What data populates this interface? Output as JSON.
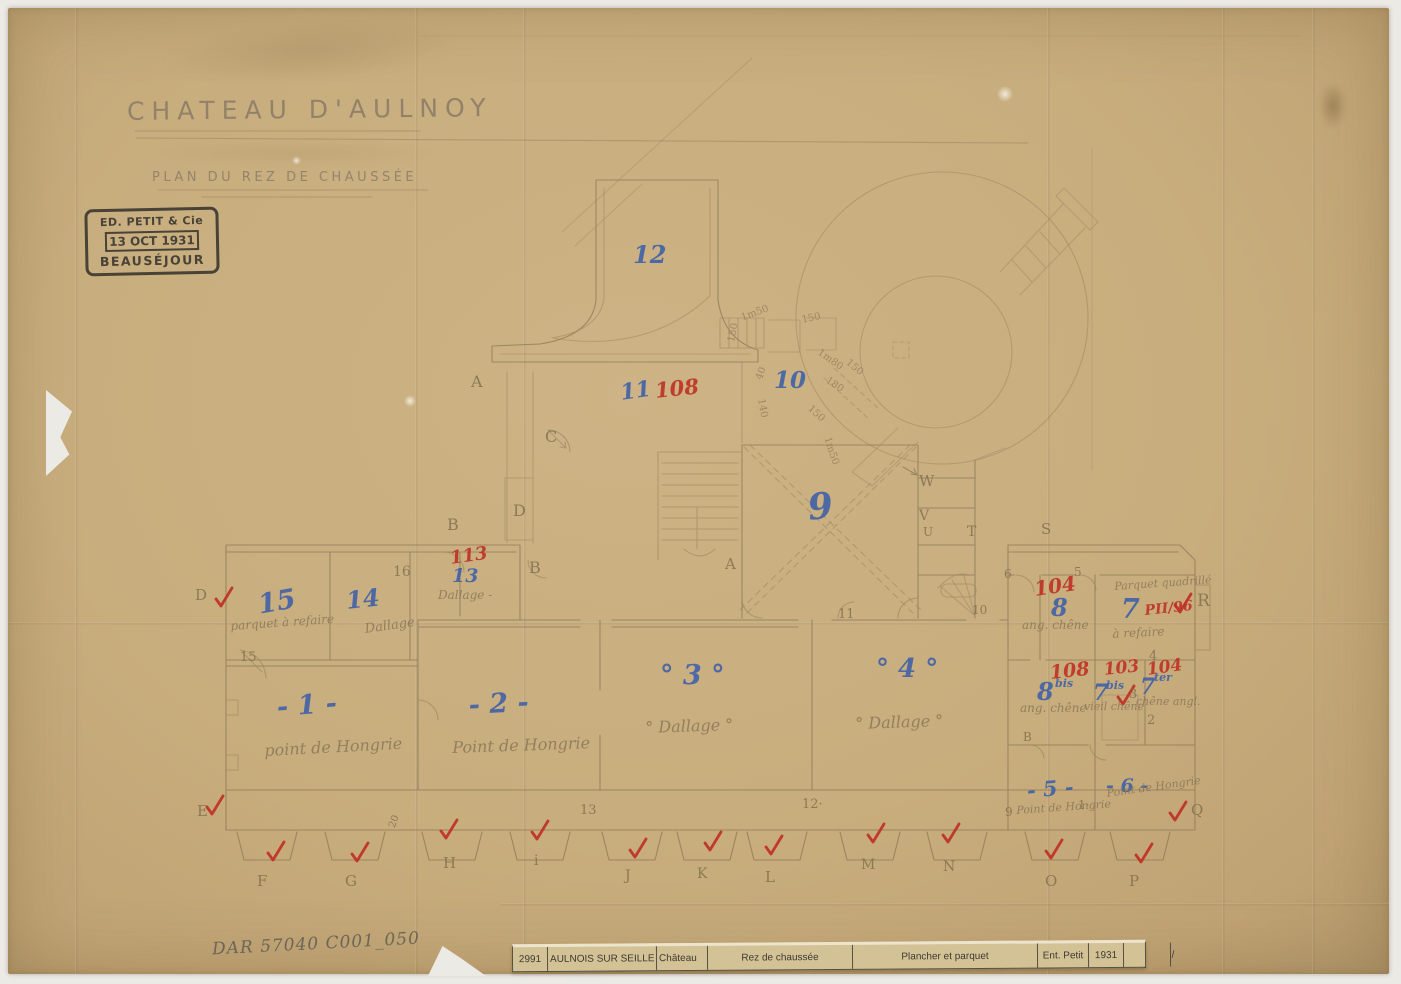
{
  "header": {
    "title": "CHATEAU D'AULNOY",
    "subtitle": "PLAN DU REZ DE CHAUSSÉE"
  },
  "stamp": {
    "line1": "ED. PETIT & Cie",
    "line2": "13 OCT 1931",
    "line3": "BEAUSÉJOUR"
  },
  "archive_ref": "DAR 57040 C001_050",
  "title_strip": {
    "cells": [
      "2991",
      "AULNOIS SUR SEILLE",
      "Château",
      "Rez de chaussée",
      "Plancher et parquet",
      "Ent. Petit",
      "1931",
      "",
      "38 / 55"
    ]
  },
  "colors": {
    "paper": "#c8ad7d",
    "ink_blue": "#3c5fa9",
    "ink_red": "#bf3024",
    "pencil": "#8c7958"
  },
  "plan": {
    "labels": [
      {
        "t": "12",
        "x": 633,
        "y": 243,
        "k": "blue",
        "s": 24
      },
      {
        "t": "11",
        "x": 619,
        "y": 382,
        "k": "blue",
        "s": 22,
        "r": -8
      },
      {
        "t": "108",
        "x": 654,
        "y": 380,
        "k": "red",
        "s": 21,
        "r": -6
      },
      {
        "t": "10",
        "x": 774,
        "y": 369,
        "k": "blue",
        "s": 23
      },
      {
        "t": "9",
        "x": 806,
        "y": 490,
        "k": "blue",
        "s": 36,
        "r": -6
      },
      {
        "t": "113",
        "x": 449,
        "y": 550,
        "k": "red",
        "s": 18,
        "r": -8
      },
      {
        "t": "13",
        "x": 452,
        "y": 567,
        "k": "blue",
        "s": 19
      },
      {
        "t": "Dallage -",
        "x": 438,
        "y": 589,
        "k": "script",
        "s": 12
      },
      {
        "t": "16",
        "x": 393,
        "y": 565,
        "k": "pencil",
        "s": 14
      },
      {
        "t": "15",
        "x": 256,
        "y": 592,
        "k": "blue",
        "s": 27,
        "r": -10
      },
      {
        "t": "14",
        "x": 345,
        "y": 589,
        "k": "blue",
        "s": 24,
        "r": -6
      },
      {
        "t": "parquet à refaire",
        "x": 230,
        "y": 620,
        "k": "script",
        "s": 12,
        "r": -4
      },
      {
        "t": "Dallage",
        "x": 364,
        "y": 623,
        "k": "script",
        "s": 13,
        "r": -8
      },
      {
        "t": "- 1 -",
        "x": 276,
        "y": 694,
        "k": "blue",
        "s": 27,
        "r": -4
      },
      {
        "t": "point de Hongrie",
        "x": 264,
        "y": 743,
        "k": "script",
        "s": 16,
        "r": -3
      },
      {
        "t": "- 2 -",
        "x": 468,
        "y": 692,
        "k": "blue",
        "s": 27,
        "r": -3
      },
      {
        "t": "Point de Hongrie",
        "x": 452,
        "y": 740,
        "k": "script",
        "s": 16,
        "r": -2
      },
      {
        "t": "° 3 °",
        "x": 660,
        "y": 662,
        "k": "blue",
        "s": 27
      },
      {
        "t": "° Dallage °",
        "x": 645,
        "y": 720,
        "k": "script",
        "s": 16,
        "r": -2
      },
      {
        "t": "° 4 °",
        "x": 876,
        "y": 656,
        "k": "blue",
        "s": 26
      },
      {
        "t": "° Dallage °",
        "x": 855,
        "y": 716,
        "k": "script",
        "s": 16,
        "r": -2
      },
      {
        "t": "- 5 -",
        "x": 1026,
        "y": 780,
        "k": "blue",
        "s": 21,
        "r": -5
      },
      {
        "t": "- 6 -",
        "x": 1106,
        "y": 777,
        "k": "blue",
        "s": 19
      },
      {
        "t": "9",
        "x": 1005,
        "y": 806,
        "k": "pencil",
        "s": 12
      },
      {
        "t": "Point de Hongrie",
        "x": 1016,
        "y": 805,
        "k": "script",
        "s": 11,
        "r": -4
      },
      {
        "t": "1·",
        "x": 1078,
        "y": 799,
        "k": "pencil",
        "s": 12
      },
      {
        "t": "Point de Hongrie",
        "x": 1106,
        "y": 788,
        "k": "script",
        "s": 11,
        "r": -8
      },
      {
        "t": "104",
        "x": 1033,
        "y": 579,
        "k": "red",
        "s": 20,
        "r": -8
      },
      {
        "t": "8",
        "x": 1051,
        "y": 596,
        "k": "blue",
        "s": 24
      },
      {
        "t": "ang. chêne",
        "x": 1022,
        "y": 619,
        "k": "script",
        "s": 12
      },
      {
        "t": "Parquet quadrillé",
        "x": 1114,
        "y": 581,
        "k": "script",
        "s": 11,
        "r": -4
      },
      {
        "t": "à refaire",
        "x": 1112,
        "y": 628,
        "k": "script",
        "s": 12,
        "r": -3
      },
      {
        "t": "7",
        "x": 1121,
        "y": 596,
        "k": "blue",
        "s": 27
      },
      {
        "t": "PII/96",
        "x": 1144,
        "y": 604,
        "k": "red",
        "s": 14,
        "r": -6
      },
      {
        "t": "108",
        "x": 1049,
        "y": 664,
        "k": "red",
        "s": 19,
        "r": -6
      },
      {
        "t": "8",
        "x": 1037,
        "y": 680,
        "k": "blue",
        "s": 24
      },
      {
        "t": "bis",
        "x": 1055,
        "y": 678,
        "k": "blue",
        "s": 11
      },
      {
        "t": "ang. chêne",
        "x": 1020,
        "y": 702,
        "k": "script",
        "s": 12
      },
      {
        "t": "103",
        "x": 1103,
        "y": 662,
        "k": "red",
        "s": 17,
        "r": -6
      },
      {
        "t": "7",
        "x": 1093,
        "y": 682,
        "k": "blue",
        "s": 22
      },
      {
        "t": "bis",
        "x": 1106,
        "y": 680,
        "k": "blue",
        "s": 11
      },
      {
        "t": "vieil chêne",
        "x": 1084,
        "y": 701,
        "k": "script",
        "s": 11
      },
      {
        "t": "104",
        "x": 1146,
        "y": 662,
        "k": "red",
        "s": 17,
        "r": -8
      },
      {
        "t": "7",
        "x": 1140,
        "y": 676,
        "k": "blue",
        "s": 22
      },
      {
        "t": "ter",
        "x": 1154,
        "y": 672,
        "k": "blue",
        "s": 11
      },
      {
        "t": "chêne angl.",
        "x": 1136,
        "y": 696,
        "k": "script",
        "s": 11
      },
      {
        "t": "3",
        "x": 1129,
        "y": 688,
        "k": "pencil",
        "s": 13
      },
      {
        "t": "2",
        "x": 1147,
        "y": 714,
        "k": "pencil",
        "s": 13
      },
      {
        "t": "4",
        "x": 1149,
        "y": 650,
        "k": "pencil",
        "s": 13
      },
      {
        "t": "B",
        "x": 1023,
        "y": 731,
        "k": "pencil",
        "s": 12
      },
      {
        "t": "A",
        "x": 471,
        "y": 374,
        "k": "pencil",
        "s": 16
      },
      {
        "t": "C",
        "x": 545,
        "y": 429,
        "k": "pencil",
        "s": 16
      },
      {
        "t": "D",
        "x": 513,
        "y": 503,
        "k": "pencil",
        "s": 16
      },
      {
        "t": "B",
        "x": 447,
        "y": 517,
        "k": "pencil",
        "s": 16
      },
      {
        "t": "B",
        "x": 529,
        "y": 560,
        "k": "pencil",
        "s": 16
      },
      {
        "t": "A",
        "x": 725,
        "y": 557,
        "k": "pencil",
        "s": 15
      },
      {
        "t": "W",
        "x": 919,
        "y": 474,
        "k": "pencil",
        "s": 15
      },
      {
        "t": "V",
        "x": 919,
        "y": 509,
        "k": "pencil",
        "s": 14
      },
      {
        "t": "U",
        "x": 923,
        "y": 526,
        "k": "pencil",
        "s": 12
      },
      {
        "t": "T",
        "x": 967,
        "y": 525,
        "k": "pencil",
        "s": 14
      },
      {
        "t": "S",
        "x": 1041,
        "y": 522,
        "k": "pencil",
        "s": 15
      },
      {
        "t": "R",
        "x": 1197,
        "y": 593,
        "k": "pencil",
        "s": 17
      },
      {
        "t": "Q",
        "x": 1191,
        "y": 803,
        "k": "pencil",
        "s": 15
      },
      {
        "t": "P",
        "x": 1129,
        "y": 874,
        "k": "pencil",
        "s": 15
      },
      {
        "t": "O",
        "x": 1045,
        "y": 874,
        "k": "pencil",
        "s": 15
      },
      {
        "t": "N",
        "x": 943,
        "y": 860,
        "k": "pencil",
        "s": 14
      },
      {
        "t": "M",
        "x": 861,
        "y": 858,
        "k": "pencil",
        "s": 14
      },
      {
        "t": "L",
        "x": 765,
        "y": 870,
        "k": "pencil",
        "s": 15
      },
      {
        "t": "K",
        "x": 697,
        "y": 867,
        "k": "pencil",
        "s": 14
      },
      {
        "t": "J",
        "x": 625,
        "y": 869,
        "k": "pencil",
        "s": 14
      },
      {
        "t": "i",
        "x": 534,
        "y": 854,
        "k": "pencil",
        "s": 14
      },
      {
        "t": "H",
        "x": 443,
        "y": 856,
        "k": "pencil",
        "s": 15
      },
      {
        "t": "G",
        "x": 345,
        "y": 874,
        "k": "pencil",
        "s": 15
      },
      {
        "t": "F",
        "x": 257,
        "y": 874,
        "k": "pencil",
        "s": 15
      },
      {
        "t": "E",
        "x": 197,
        "y": 804,
        "k": "pencil",
        "s": 15
      },
      {
        "t": "D",
        "x": 195,
        "y": 588,
        "k": "pencil",
        "s": 15
      },
      {
        "t": "15",
        "x": 240,
        "y": 651,
        "k": "pencil",
        "s": 13
      },
      {
        "t": "13",
        "x": 580,
        "y": 804,
        "k": "pencil",
        "s": 13
      },
      {
        "t": "12·",
        "x": 802,
        "y": 798,
        "k": "pencil",
        "s": 13
      },
      {
        "t": "11",
        "x": 838,
        "y": 608,
        "k": "pencil",
        "s": 13
      },
      {
        "t": "10",
        "x": 972,
        "y": 604,
        "k": "pencil",
        "s": 12
      },
      {
        "t": "6",
        "x": 1004,
        "y": 568,
        "k": "pencil",
        "s": 12
      },
      {
        "t": "5",
        "x": 1074,
        "y": 566,
        "k": "pencil",
        "s": 12
      },
      {
        "t": "20",
        "x": 388,
        "y": 826,
        "k": "pencil",
        "s": 10,
        "r": -70
      },
      {
        "t": "1m50",
        "x": 740,
        "y": 314,
        "k": "meas",
        "s": 10,
        "r": -20
      },
      {
        "t": "150",
        "x": 727,
        "y": 341,
        "k": "meas",
        "s": 10,
        "r": -78
      },
      {
        "t": "150",
        "x": 801,
        "y": 316,
        "k": "meas",
        "s": 10,
        "r": -12
      },
      {
        "t": "1m80",
        "x": 821,
        "y": 348,
        "k": "meas",
        "s": 10,
        "r": 35
      },
      {
        "t": "40",
        "x": 755,
        "y": 378,
        "k": "meas",
        "s": 10,
        "r": -70
      },
      {
        "t": "140",
        "x": 765,
        "y": 398,
        "k": "meas",
        "s": 10,
        "r": 80
      },
      {
        "t": "150",
        "x": 812,
        "y": 404,
        "k": "meas",
        "s": 10,
        "r": 42
      },
      {
        "t": "1m50",
        "x": 831,
        "y": 436,
        "k": "meas",
        "s": 10,
        "r": 72
      },
      {
        "t": "180",
        "x": 829,
        "y": 376,
        "k": "meas",
        "s": 10,
        "r": 33
      },
      {
        "t": "150",
        "x": 850,
        "y": 358,
        "k": "meas",
        "s": 10,
        "r": 40
      }
    ],
    "checks": [
      [
        222,
        598
      ],
      [
        213,
        806
      ],
      [
        274,
        852
      ],
      [
        358,
        853
      ],
      [
        447,
        830
      ],
      [
        538,
        831
      ],
      [
        636,
        849
      ],
      [
        711,
        842
      ],
      [
        772,
        846
      ],
      [
        874,
        834
      ],
      [
        949,
        834
      ],
      [
        1052,
        850
      ],
      [
        1142,
        854
      ],
      [
        1176,
        812
      ],
      [
        1181,
        604
      ],
      [
        1124,
        696
      ]
    ]
  }
}
